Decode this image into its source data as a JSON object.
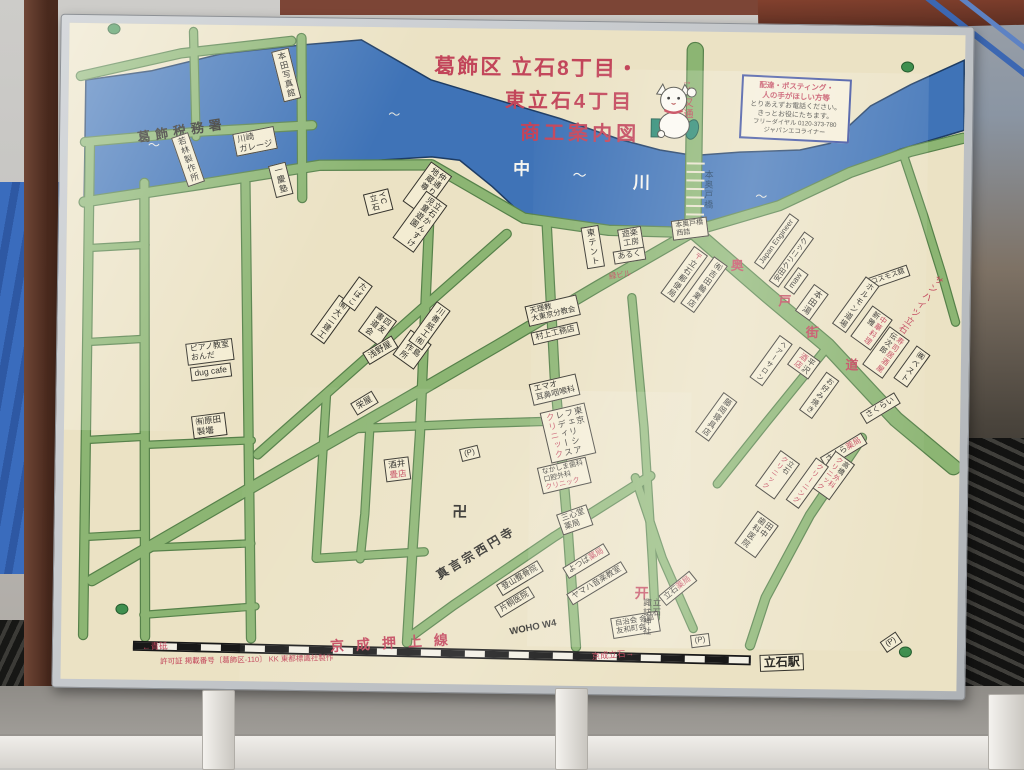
{
  "colors": {
    "map_bg": "#ebe2c4",
    "road_fill": "#8cb573",
    "road_edge": "#56814a",
    "river": "#3f73b7",
    "river_edge": "#1e3c63",
    "accent_red": "#c2455a",
    "ink": "#2b2a26",
    "box_bg": "#f3ecd2",
    "notice_border": "#3a4d9e"
  },
  "notice": {
    "lines": [
      "配達・ポスティング・",
      "人の手がほしい方等",
      "とりあえずお電話ください。",
      "きっとお役にたちます。",
      "フリーダイヤル 0120-373-780",
      "ジャパンエコライナー"
    ]
  },
  "labels": [
    {
      "n": "map-title-line-1",
      "t": "葛飾区 立石8丁目・",
      "x": 534,
      "y": 67,
      "fs": 21,
      "red": 1,
      "b": 1,
      "ls": 2
    },
    {
      "n": "map-title-line-2",
      "t": "東立石4丁目",
      "x": 567,
      "y": 100,
      "fs": 20,
      "red": 1,
      "b": 1,
      "ls": 3
    },
    {
      "n": "map-title-line-3",
      "t": "商工案内図",
      "x": 578,
      "y": 132,
      "fs": 20,
      "red": 1,
      "b": 1,
      "ls": 4
    },
    {
      "n": "river-name",
      "t": "中",
      "x": 520,
      "y": 168,
      "fs": 17,
      "c": "#f6f5ef",
      "b": 1
    },
    {
      "n": "river-tilde",
      "t": "〜",
      "x": 578,
      "y": 174,
      "fs": 14,
      "c": "#f6f5ef"
    },
    {
      "n": "river-name",
      "t": "川",
      "x": 640,
      "y": 180,
      "fs": 17,
      "c": "#f6f5ef",
      "b": 1
    },
    {
      "n": "river-wave",
      "t": "〜",
      "x": 152,
      "y": 150,
      "fs": 12,
      "c": "#e9e8df"
    },
    {
      "n": "river-wave",
      "t": "〜",
      "x": 392,
      "y": 116,
      "fs": 12,
      "c": "#e9e8df"
    },
    {
      "n": "river-wave",
      "t": "〜",
      "x": 845,
      "y": 116,
      "fs": 12,
      "c": "#e9e8df"
    },
    {
      "n": "river-wave",
      "t": "〜",
      "x": 760,
      "y": 193,
      "fs": 12,
      "c": "#e9e8df"
    },
    {
      "n": "bridge-name",
      "t": "本奥戸橋",
      "x": 707,
      "y": 186,
      "v": 1,
      "fs": 9,
      "c": "#16395f"
    },
    {
      "n": "road-name-shibamata-dori",
      "t": "↑柴又通り",
      "x": 684,
      "y": 102,
      "v": 1,
      "fs": 10,
      "red": 1
    },
    {
      "n": "road-name-okudo-kaido",
      "t": "奥",
      "x": 737,
      "y": 262,
      "fs": 13,
      "red": 1,
      "b": 1
    },
    {
      "n": "road-name-okudo-kaido",
      "t": "戸",
      "x": 785,
      "y": 297,
      "fs": 13,
      "red": 1,
      "b": 1
    },
    {
      "n": "road-name-okudo-kaido",
      "t": "街",
      "x": 813,
      "y": 328,
      "fs": 13,
      "red": 1,
      "b": 1
    },
    {
      "n": "road-name-okudo-kaido",
      "t": "道",
      "x": 853,
      "y": 360,
      "fs": 13,
      "red": 1,
      "b": 1
    },
    {
      "n": "poi-sun-heights",
      "t": "サンハイツ立石",
      "x": 921,
      "y": 298,
      "rot": 35,
      "v": 1,
      "fs": 9,
      "red": 1
    },
    {
      "n": "poi-tax-office",
      "t": "葛飾税務署",
      "x": 180,
      "y": 135,
      "rot": -10,
      "fs": 13,
      "ls": 5,
      "b": 1
    },
    {
      "n": "poi",
      "t": "本田写真館",
      "x": 283,
      "y": 77,
      "rot": -15,
      "v": 1,
      "box": 1,
      "fs": 8.5
    },
    {
      "n": "poi",
      "t": "若林製作所",
      "x": 186,
      "y": 163,
      "rot": -20,
      "v": 1,
      "box": 1,
      "fs": 8.5
    },
    {
      "n": "poi",
      "t": "川崎\nガレージ",
      "x": 253,
      "y": 144,
      "rot": -12,
      "box": 1,
      "fs": 8.5
    },
    {
      "n": "poi",
      "t": "一慶塾",
      "x": 279,
      "y": 182,
      "rot": -15,
      "v": 1,
      "box": 1,
      "fs": 8.5
    },
    {
      "n": "poi",
      "t": "ピアノ教室\nおんだ",
      "x": 211,
      "y": 355,
      "rot": -8,
      "box": 1,
      "fs": 8
    },
    {
      "n": "poi",
      "t": "dug cafe",
      "x": 212,
      "y": 375,
      "rot": -8,
      "box": 1,
      "fs": 8.5
    },
    {
      "n": "poi",
      "t": "㈲原田\n製壜",
      "x": 211,
      "y": 429,
      "rot": -8,
      "box": 1,
      "fs": 8.5
    },
    {
      "n": "poi",
      "t": "㈲大二建工",
      "x": 332,
      "y": 321,
      "rot": 35,
      "v": 1,
      "box": 1,
      "fs": 8
    },
    {
      "n": "poi",
      "t": "たばこ",
      "x": 357,
      "y": 295,
      "rot": 35,
      "v": 1,
      "box": 1,
      "fs": 8
    },
    {
      "n": "poi",
      "t": "四友\n書道会",
      "x": 378,
      "y": 327,
      "rot": 35,
      "v": 1,
      "box": 1,
      "fs": 8
    },
    {
      "n": "poi",
      "t": "浅野屋",
      "x": 381,
      "y": 351,
      "rot": -32,
      "box": 1,
      "fs": 8.5
    },
    {
      "n": "poi",
      "t": "香島\n製作所",
      "x": 413,
      "y": 350,
      "rot": 35,
      "v": 1,
      "box": 1,
      "fs": 8
    },
    {
      "n": "poi",
      "t": "川善紙工㈲",
      "x": 430,
      "y": 326,
      "rot": 35,
      "v": 1,
      "box": 1,
      "fs": 8
    },
    {
      "n": "poi",
      "t": "栄屋",
      "x": 366,
      "y": 404,
      "rot": -32,
      "box": 1,
      "fs": 8.5
    },
    {
      "n": "poi",
      "t": "YC\n立石",
      "x": 377,
      "y": 203,
      "rot": -15,
      "v": 1,
      "box": 1,
      "fs": 8
    },
    {
      "n": "poi",
      "t": "仲通り子育\n地蔵尊",
      "x": 426,
      "y": 189,
      "rot": 35,
      "v": 1,
      "box": 1,
      "fs": 8
    },
    {
      "n": "poi",
      "t": "立石かんすけ\n児童遊園",
      "x": 419,
      "y": 222,
      "rot": 35,
      "v": 1,
      "box": 1,
      "fs": 8
    },
    {
      "n": "poi",
      "t": "東テント",
      "x": 592,
      "y": 245,
      "rot": -10,
      "v": 1,
      "box": 1,
      "fs": 8.5
    },
    {
      "n": "poi",
      "t": "天理教\n大東京分教会",
      "x": 553,
      "y": 309,
      "rot": -14,
      "box": 1,
      "fs": 7.5
    },
    {
      "n": "poi",
      "t": "村上工務店",
      "x": 556,
      "y": 332,
      "rot": -14,
      "box": 1,
      "fs": 8
    },
    {
      "n": "poi",
      "t": "エマオ\n耳鼻咽喉科",
      "x": 556,
      "y": 388,
      "rot": -14,
      "box": 1,
      "fs": 8
    },
    {
      "n": "poi",
      "parts": [
        {
          "s": "東京\nフェリシア\nレディース\n"
        },
        {
          "s": "クリニック",
          "r": 1
        }
      ],
      "x": 570,
      "y": 431,
      "rot": -14,
      "v": 1,
      "box": 1,
      "fs": 8.5
    },
    {
      "n": "poi",
      "parts": [
        {
          "s": "なかしま歯科\n口腔外科\n"
        },
        {
          "s": "クリニック",
          "r": 1
        }
      ],
      "x": 567,
      "y": 474,
      "rot": -14,
      "box": 1,
      "fs": 7
    },
    {
      "n": "poi-temple-manji",
      "t": "卍",
      "x": 463,
      "y": 513,
      "fs": 15,
      "b": 1
    },
    {
      "n": "poi-temple",
      "t": "真言宗西円寺",
      "x": 480,
      "y": 553,
      "rot": -32,
      "fs": 12,
      "ls": 3,
      "b": 1
    },
    {
      "n": "poi",
      "t": "三心堂\n薬局",
      "x": 578,
      "y": 518,
      "rot": -20,
      "box": 1,
      "fs": 8
    },
    {
      "n": "poi",
      "parts": [
        {
          "s": "よつば"
        },
        {
          "s": "薬局",
          "r": 1
        }
      ],
      "x": 590,
      "y": 559,
      "rot": -32,
      "box": 1,
      "fs": 8
    },
    {
      "n": "poi",
      "t": "ヤマハ音楽教室",
      "x": 601,
      "y": 581,
      "rot": -32,
      "box": 1,
      "fs": 8
    },
    {
      "n": "poi",
      "t": "登山整骨院",
      "x": 524,
      "y": 577,
      "rot": -32,
      "box": 1,
      "fs": 8
    },
    {
      "n": "poi",
      "t": "片桐医院",
      "x": 519,
      "y": 601,
      "rot": -32,
      "box": 1,
      "fs": 8
    },
    {
      "n": "poi",
      "t": "自治会 会館\n友和町会",
      "x": 640,
      "y": 622,
      "rot": -10,
      "box": 1,
      "fs": 7.5
    },
    {
      "n": "road-name-woho",
      "t": "WOHO W4",
      "x": 538,
      "y": 627,
      "rot": -12,
      "fs": 9.5,
      "b": 1
    },
    {
      "n": "poi-shrine-torii",
      "t": "开",
      "x": 646,
      "y": 591,
      "fs": 14,
      "red": 1,
      "b": 1
    },
    {
      "n": "poi-shrine",
      "t": "立石\n諏訪神社",
      "x": 656,
      "y": 614,
      "v": 1,
      "fs": 8.5
    },
    {
      "n": "poi",
      "parts": [
        {
          "s": "立石"
        },
        {
          "s": "薬局",
          "r": 1
        }
      ],
      "x": 682,
      "y": 585,
      "rot": -40,
      "box": 1,
      "fs": 8
    },
    {
      "n": "poi",
      "t": "田中\n歯科医院",
      "x": 760,
      "y": 530,
      "rot": 35,
      "v": 1,
      "box": 1,
      "fs": 8
    },
    {
      "n": "parking-label",
      "t": "(P)",
      "x": 705,
      "y": 637,
      "rot": -8,
      "box": 1,
      "fs": 8
    },
    {
      "n": "parking-label",
      "t": "(P)",
      "x": 472,
      "y": 453,
      "rot": -15,
      "box": 1,
      "fs": 8
    },
    {
      "n": "parking-label",
      "t": "(P)",
      "x": 896,
      "y": 636,
      "rot": -35,
      "box": 1,
      "fs": 8
    },
    {
      "n": "poi",
      "parts": [
        {
          "s": "酒井\n"
        },
        {
          "s": "畳店",
          "r": 1
        }
      ],
      "x": 400,
      "y": 470,
      "rot": -8,
      "box": 1,
      "fs": 8.5
    },
    {
      "n": "station-tateishi",
      "t": "立石駅",
      "x": 787,
      "y": 658,
      "rot": -3,
      "box": 1,
      "fs": 12,
      "b": 1
    },
    {
      "n": "railway-dir-right",
      "t": "京成立石→",
      "x": 618,
      "y": 653,
      "rot": -6,
      "fs": 8.5,
      "red": 1
    },
    {
      "n": "railway-dir-left",
      "t": "←青砥",
      "x": 160,
      "y": 651,
      "rot": -3,
      "fs": 8.5,
      "red": 1
    },
    {
      "n": "railway-name",
      "t": "京成押上線",
      "x": 400,
      "y": 644,
      "rot": -4,
      "fs": 14,
      "red": 1,
      "ls": 12,
      "b": 1
    },
    {
      "n": "permit-note",
      "t": "許可証 掲載番号〔葛飾区-110〕 KK 東都標識社製作",
      "x": 252,
      "y": 663,
      "rot": -2,
      "fs": 7.5,
      "red": 1
    },
    {
      "n": "poi",
      "t": "遊楽\n工房",
      "x": 630,
      "y": 236,
      "rot": -10,
      "box": 1,
      "fs": 8
    },
    {
      "n": "poi",
      "t": "あるく",
      "x": 629,
      "y": 253,
      "rot": -10,
      "box": 1,
      "fs": 8
    },
    {
      "n": "poi-midori-bldg",
      "t": "緑ビル",
      "x": 620,
      "y": 273,
      "rot": -10,
      "fs": 7.5,
      "red": 1
    },
    {
      "n": "poi",
      "t": "本奥戸橋\n西詰",
      "x": 689,
      "y": 225,
      "rot": -8,
      "box": 1,
      "fs": 7
    },
    {
      "n": "poi-post-office",
      "parts": [
        {
          "s": "〒",
          "r": 1
        },
        {
          "s": "立石郵便局"
        }
      ],
      "x": 684,
      "y": 271,
      "rot": 35,
      "v": 1,
      "box": 1,
      "fs": 8
    },
    {
      "n": "poi",
      "t": "㈲吉田輪業店",
      "x": 704,
      "y": 281,
      "rot": 35,
      "v": 1,
      "box": 1,
      "fs": 8
    },
    {
      "n": "poi",
      "t": "Japan Engineer",
      "x": 776,
      "y": 237,
      "rot": -55,
      "box": 1,
      "fs": 7.5
    },
    {
      "n": "poi",
      "t": "安田クリニック",
      "x": 791,
      "y": 255,
      "rot": -55,
      "box": 1,
      "fs": 7.5
    },
    {
      "n": "poi",
      "t": "maw",
      "x": 796,
      "y": 276,
      "rot": -55,
      "box": 1,
      "fs": 8
    },
    {
      "n": "poi",
      "t": "本田湯",
      "x": 812,
      "y": 297,
      "rot": 35,
      "v": 1,
      "box": 1,
      "fs": 8.5
    },
    {
      "n": "poi",
      "t": "コスモス舘",
      "x": 888,
      "y": 271,
      "rot": -20,
      "box": 1,
      "fs": 7
    },
    {
      "n": "poi",
      "t": "ホルモン道場",
      "x": 856,
      "y": 299,
      "rot": 35,
      "v": 1,
      "box": 1,
      "fs": 8
    },
    {
      "n": "poi",
      "parts": [
        {
          "s": "中華料理\n",
          "r": 1
        },
        {
          "s": "新雅"
        }
      ],
      "x": 872,
      "y": 322,
      "rot": 35,
      "v": 1,
      "box": 1,
      "fs": 7.5
    },
    {
      "n": "poi",
      "parts": [
        {
          "s": "寿司居酒屋\n",
          "r": 1
        },
        {
          "s": "伝次郎"
        }
      ],
      "x": 887,
      "y": 346,
      "rot": 35,
      "v": 1,
      "box": 1,
      "fs": 7.5
    },
    {
      "n": "poi",
      "t": "㈱ベスト",
      "x": 913,
      "y": 360,
      "rot": 35,
      "v": 1,
      "box": 1,
      "fs": 8
    },
    {
      "n": "poi",
      "t": "ヘアーサロン",
      "x": 772,
      "y": 356,
      "rot": 35,
      "v": 1,
      "box": 1,
      "fs": 7
    },
    {
      "n": "poi",
      "parts": [
        {
          "s": "平沢\n"
        },
        {
          "s": "酒店",
          "r": 1
        }
      ],
      "x": 805,
      "y": 358,
      "rot": 35,
      "v": 1,
      "box": 1,
      "fs": 8
    },
    {
      "n": "poi",
      "t": "お好み焼き",
      "x": 821,
      "y": 390,
      "rot": 35,
      "v": 1,
      "box": 1,
      "fs": 7.5
    },
    {
      "n": "poi",
      "t": "さくらい",
      "x": 882,
      "y": 402,
      "rot": -32,
      "box": 1,
      "fs": 8
    },
    {
      "n": "poi",
      "parts": [
        {
          "s": "さくら"
        },
        {
          "s": "薬局",
          "r": 1
        }
      ],
      "x": 846,
      "y": 445,
      "rot": -32,
      "box": 1,
      "fs": 8
    },
    {
      "n": "poi",
      "parts": [
        {
          "s": "高橋"
        },
        {
          "s": "外科\n",
          "r": 1
        },
        {
          "s": "クリニック",
          "r": 1
        }
      ],
      "x": 835,
      "y": 470,
      "rot": 35,
      "v": 1,
      "box": 1,
      "fs": 7
    },
    {
      "n": "poi",
      "parts": [
        {
          "s": "立石\n"
        },
        {
          "s": "クリニック",
          "r": 1
        }
      ],
      "x": 780,
      "y": 470,
      "rot": 35,
      "v": 1,
      "box": 1,
      "fs": 7
    },
    {
      "n": "poi",
      "t": "クリーニング",
      "x": 810,
      "y": 478,
      "rot": 35,
      "v": 1,
      "box": 1,
      "fs": 7,
      "red": 1
    },
    {
      "n": "poi",
      "t": "藤岡寝具店",
      "x": 718,
      "y": 413,
      "rot": 35,
      "v": 1,
      "box": 1,
      "fs": 8
    }
  ]
}
